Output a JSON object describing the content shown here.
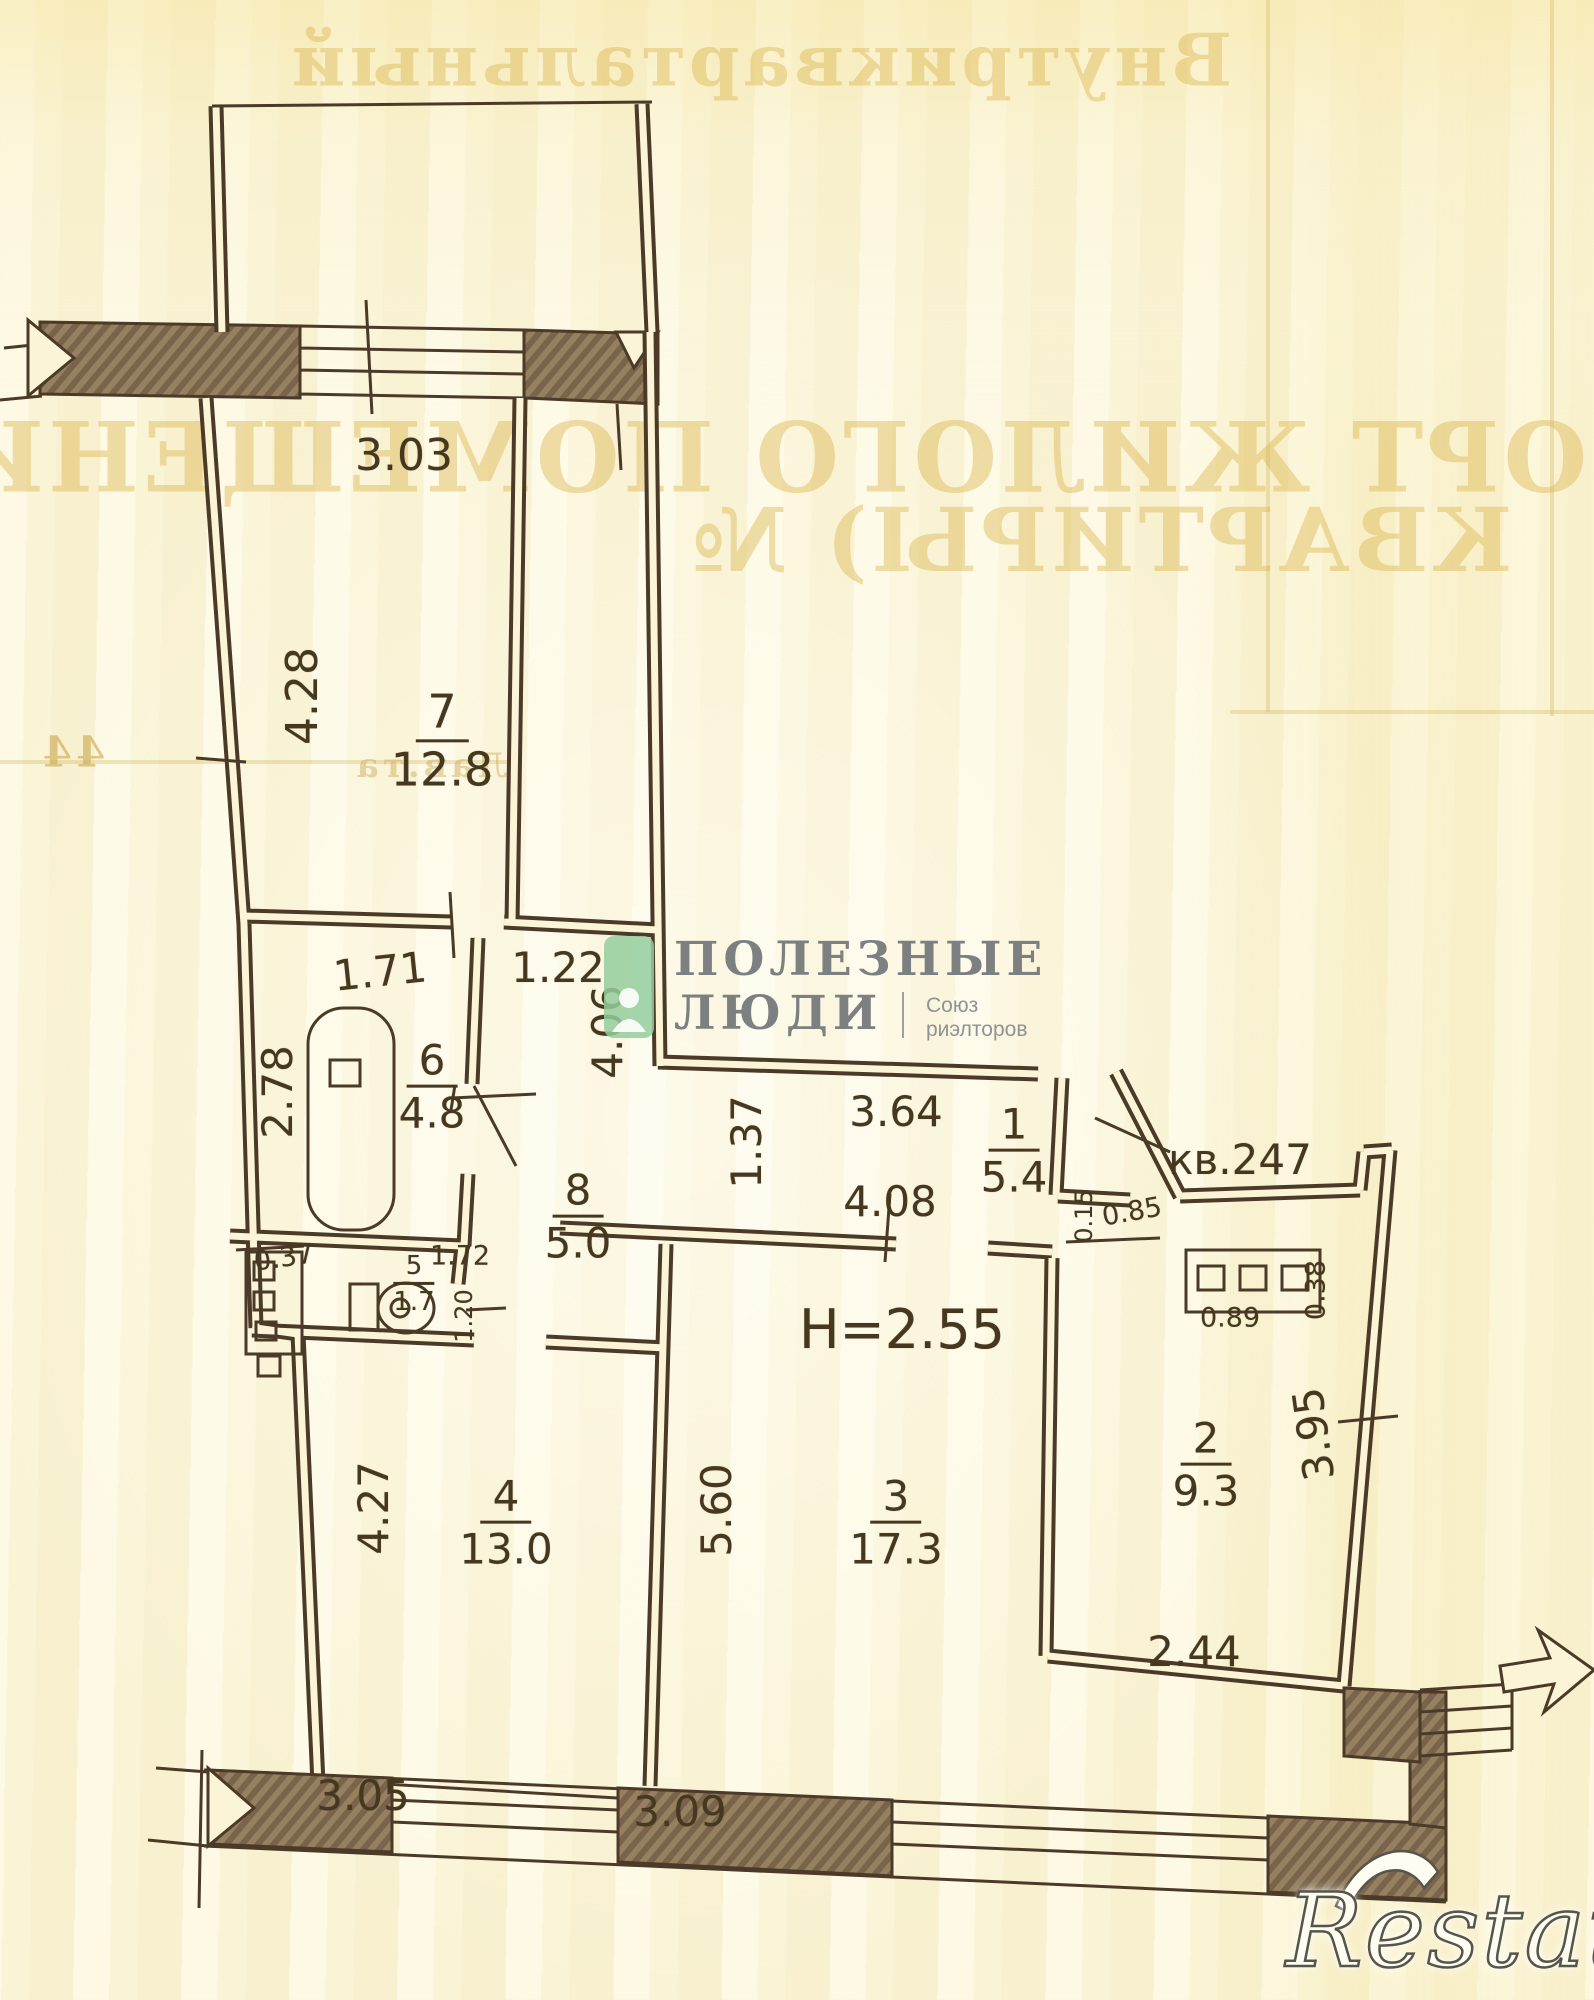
{
  "page": {
    "width": 1594,
    "height": 2000,
    "paper_color": "#fbf4d6",
    "ink_color": "#4a3a27",
    "label_color": "#46371f"
  },
  "bleed_text": {
    "top_line": "Внутриквартальный",
    "title_line1": "ПАСПОРТ ЖИЛОГО ПОМЕЩЕНИЯ",
    "title_line2": "КВАРТИРЫ) №",
    "left_number": "44",
    "left_note": "Лав.та",
    "color": "#d8b24a"
  },
  "watermark": {
    "brand_line1": "ПОЛЕЗНЫЕ",
    "brand_line2": "ЛЮДИ",
    "union_line1": "Союз",
    "union_line2": "риэлторов",
    "green_color": "#94cc9c",
    "text_color": "#717578"
  },
  "corner_logo": {
    "text": "Restate"
  },
  "plan": {
    "ceiling_height": "H=2.55",
    "apartment_number": "кв.247",
    "fixtures": [
      "bathtub",
      "sink",
      "toilet",
      "vent-shaft",
      "built-in-closet",
      "entrance-door",
      "balcony-top",
      "balcony-bottom",
      "exit-arrow"
    ],
    "rooms": [
      {
        "number": "7",
        "area": "12.8",
        "x": 442,
        "y": 740,
        "size": 46
      },
      {
        "number": "6",
        "area": "4.8",
        "x": 432,
        "y": 1086,
        "size": 42
      },
      {
        "number": "8",
        "area": "5.0",
        "x": 578,
        "y": 1216,
        "size": 42
      },
      {
        "number": "1",
        "area": "5.4",
        "x": 1014,
        "y": 1150,
        "size": 42
      },
      {
        "number": "5",
        "area": "1.7",
        "x": 414,
        "y": 1283,
        "size": 26
      },
      {
        "number": "4",
        "area": "13.0",
        "x": 506,
        "y": 1522,
        "size": 42
      },
      {
        "number": "3",
        "area": "17.3",
        "x": 896,
        "y": 1522,
        "size": 42
      },
      {
        "number": "2",
        "area": "9.3",
        "x": 1206,
        "y": 1464,
        "size": 42
      }
    ],
    "dimensions": [
      {
        "text": "3.03",
        "x": 404,
        "y": 456,
        "rot": 0,
        "size": 44
      },
      {
        "text": "4.28",
        "x": 303,
        "y": 696,
        "rot": -90,
        "size": 44
      },
      {
        "text": "1.71",
        "x": 380,
        "y": 972,
        "rot": -6,
        "size": 42
      },
      {
        "text": "1.22",
        "x": 558,
        "y": 968,
        "rot": 0,
        "size": 42
      },
      {
        "text": "2.78",
        "x": 278,
        "y": 1092,
        "rot": -90,
        "size": 42
      },
      {
        "text": "4.06",
        "x": 608,
        "y": 1032,
        "rot": -90,
        "size": 42
      },
      {
        "text": "1.37",
        "x": 747,
        "y": 1142,
        "rot": -90,
        "size": 42
      },
      {
        "text": "3.64",
        "x": 896,
        "y": 1112,
        "rot": 0,
        "size": 42
      },
      {
        "text": "4.08",
        "x": 890,
        "y": 1202,
        "rot": 0,
        "size": 42
      },
      {
        "text": "0.15",
        "x": 1084,
        "y": 1216,
        "rot": -90,
        "size": 24
      },
      {
        "text": "0.85",
        "x": 1132,
        "y": 1212,
        "rot": -10,
        "size": 27
      },
      {
        "text": "0.89",
        "x": 1230,
        "y": 1318,
        "rot": 0,
        "size": 27
      },
      {
        "text": "0.38",
        "x": 1316,
        "y": 1290,
        "rot": -90,
        "size": 27
      },
      {
        "text": "3.95",
        "x": 1314,
        "y": 1434,
        "rot": -98,
        "size": 42
      },
      {
        "text": "0.37",
        "x": 284,
        "y": 1258,
        "rot": -8,
        "size": 27
      },
      {
        "text": "1.72",
        "x": 460,
        "y": 1256,
        "rot": 0,
        "size": 27
      },
      {
        "text": "1.20",
        "x": 464,
        "y": 1316,
        "rot": -90,
        "size": 24
      },
      {
        "text": "4.27",
        "x": 374,
        "y": 1508,
        "rot": -90,
        "size": 42
      },
      {
        "text": "5.60",
        "x": 717,
        "y": 1510,
        "rot": -90,
        "size": 42
      },
      {
        "text": "2.44",
        "x": 1194,
        "y": 1652,
        "rot": 0,
        "size": 42
      },
      {
        "text": "3.05",
        "x": 363,
        "y": 1796,
        "rot": 0,
        "size": 42
      },
      {
        "text": "3.09",
        "x": 680,
        "y": 1812,
        "rot": 0,
        "size": 42
      }
    ]
  }
}
